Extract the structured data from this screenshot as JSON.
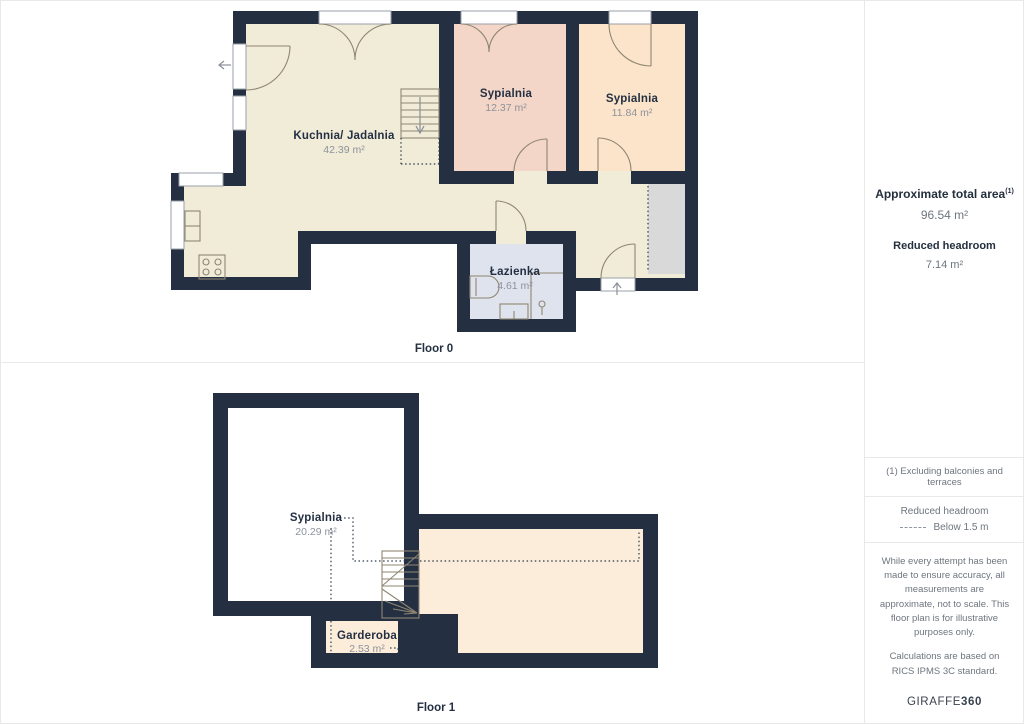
{
  "floors": [
    {
      "label": "Floor 0",
      "rooms": [
        {
          "name": "Kuchnia/ Jadalnia",
          "area": "42.39 m²"
        },
        {
          "name": "Sypialnia",
          "area": "12.37 m²"
        },
        {
          "name": "Sypialnia",
          "area": "11.84 m²"
        },
        {
          "name": "Łazienka",
          "area": "4.61 m²"
        }
      ]
    },
    {
      "label": "Floor 1",
      "rooms": [
        {
          "name": "Sypialnia",
          "area": "20.29 m²"
        },
        {
          "name": "Garderoba",
          "area": "2.53 m²"
        }
      ]
    }
  ],
  "sidebar": {
    "total_area_label": "Approximate total area",
    "total_area_superscript": "(1)",
    "total_area_value": "96.54 m²",
    "reduced_headroom_label": "Reduced headroom",
    "reduced_headroom_value": "7.14 m²",
    "footnote": "(1) Excluding balconies and terraces",
    "legend_title": "Reduced headroom",
    "legend_value": "Below 1.5 m",
    "disclaimer_1": "While every attempt has been made to ensure accuracy, all measurements are approximate, not to scale. This floor plan is for illustrative purposes only.",
    "disclaimer_2": "Calculations are based on RICS IPMS 3C standard.",
    "brand_name": "GIRAFFE",
    "brand_number": "360"
  },
  "colors": {
    "wall": "#243042",
    "kitchen_floor": "#f1ecd8",
    "bedroom1_floor": "#f3d6c8",
    "bedroom2_floor": "#fbe4ca",
    "bathroom_floor": "#dfe3ee",
    "attic_floor": "#fcecda",
    "closet_area": "#d9d9d9",
    "room_label": "#243042",
    "area_label": "#8d929b"
  }
}
